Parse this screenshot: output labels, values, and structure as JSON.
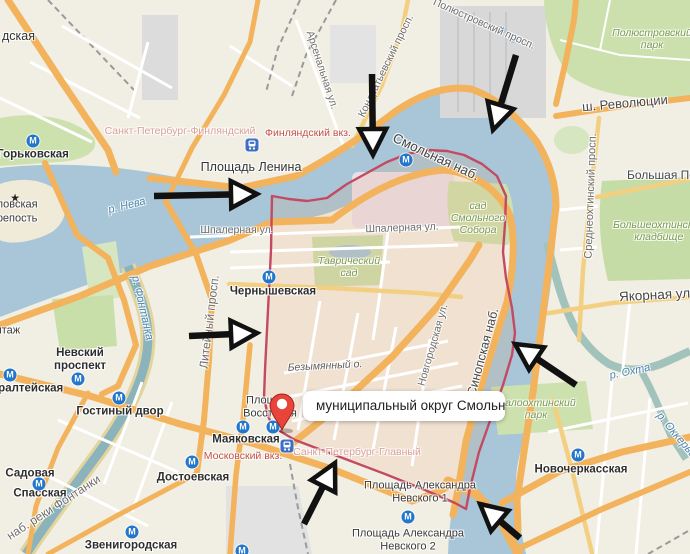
{
  "info_label": {
    "text": "муниципальный округ Смольн..."
  },
  "colors": {
    "water": "#a8c6d8",
    "land": "#f1eee3",
    "road_major": "#f2b35c",
    "road_secondary": "#f3cf82",
    "district_boundary": "#c24a62",
    "district_fill": "rgba(232,146,100,0.14)",
    "arrow": "#111111",
    "pin": "#e8443a",
    "metro_blue": "#2276cc",
    "rail_blue": "#3f6fc4",
    "park_green": "#cde1ae",
    "rail_text_red": "#c35049"
  },
  "icons": {
    "metro_letter": "М",
    "fortress_star": "★"
  },
  "star": {
    "x": 15,
    "y": 198
  },
  "labels": [
    {
      "text": "дская",
      "cls": "place-lg",
      "x": 2,
      "y": 36,
      "left": true
    },
    {
      "text": "Горьковская",
      "cls": "place-bold",
      "x": 33,
      "y": 155
    },
    {
      "text": "Санкт-Петербург-Финляндский",
      "cls": "rail-pale",
      "x": 180,
      "y": 131
    },
    {
      "text": "Финляндский вкз.",
      "cls": "rail-red",
      "x": 308,
      "y": 133
    },
    {
      "text": "Площадь Ленина",
      "cls": "place-lg",
      "x": 251,
      "y": 167
    },
    {
      "text": "Арсенальная ул.",
      "cls": "street",
      "x": 322,
      "y": 70,
      "rot": 72
    },
    {
      "text": "Кондратьевский просп.",
      "cls": "street",
      "x": 386,
      "y": 66,
      "rot": -64
    },
    {
      "text": "Полюстровский просп.",
      "cls": "street",
      "x": 484,
      "y": 24,
      "rot": 24
    },
    {
      "text": "Полюстровский\nпарк",
      "cls": "park-lbl",
      "x": 652,
      "y": 39
    },
    {
      "text": "ш. Революции",
      "cls": "street-dark",
      "x": 625,
      "y": 104,
      "rot": -5,
      "fs": 13
    },
    {
      "text": "Смольная наб.",
      "cls": "street-dark",
      "x": 436,
      "y": 157,
      "rot": 25,
      "fs": 13.5
    },
    {
      "text": "Среднеохтинский просп.",
      "cls": "street",
      "x": 591,
      "y": 196,
      "rot": -88,
      "fs": 11
    },
    {
      "text": "Большая Пороховская",
      "cls": "street-dark",
      "x": 627,
      "y": 176,
      "left": true
    },
    {
      "text": "Большеохтинское\nкладбище",
      "cls": "park-lbl",
      "x": 613,
      "y": 231,
      "left": true
    },
    {
      "text": "Якорная ул.",
      "cls": "street-dark",
      "x": 619,
      "y": 295,
      "left": true,
      "rot": -3,
      "fs": 13.5
    },
    {
      "text": "р. Нева",
      "cls": "water-lbl",
      "x": 127,
      "y": 206,
      "rot": -14
    },
    {
      "text": "Петропавловская",
      "cls": "place",
      "x": -52,
      "y": 205,
      "left": true
    },
    {
      "text": "крепость",
      "cls": "place",
      "x": -8,
      "y": 219,
      "left": true
    },
    {
      "text": "Эрмитаж",
      "cls": "place",
      "x": -26,
      "y": 331,
      "left": true
    },
    {
      "text": "Шпалерная ул.",
      "cls": "street",
      "x": 237,
      "y": 230
    },
    {
      "text": "Шпалерная ул.",
      "cls": "street",
      "x": 402,
      "y": 228,
      "rot": -2
    },
    {
      "text": "Таврический\nсад",
      "cls": "park-lbl",
      "x": 349,
      "y": 267
    },
    {
      "text": "Чернышевская",
      "cls": "place-bold",
      "x": 273,
      "y": 292
    },
    {
      "text": "Литейный просп.",
      "cls": "street",
      "x": 210,
      "y": 322,
      "rot": -83,
      "fs": 12
    },
    {
      "text": "р. Фонтанка",
      "cls": "water-lbl",
      "x": 142,
      "y": 308,
      "rot": 77
    },
    {
      "text": "наб. реки Фонтанки",
      "cls": "street",
      "x": 54,
      "y": 508,
      "rot": -33,
      "fs": 12
    },
    {
      "text": "Невский\nпроспект",
      "cls": "place-bold",
      "x": 80,
      "y": 360
    },
    {
      "text": "Адмиралтейская",
      "cls": "place-bold",
      "x": -33,
      "y": 389,
      "left": true
    },
    {
      "text": "Гостиный двор",
      "cls": "place-bold",
      "x": 120,
      "y": 412
    },
    {
      "text": "Садовая",
      "cls": "place-bold",
      "x": 30,
      "y": 474
    },
    {
      "text": "Спасская",
      "cls": "place-bold",
      "x": 40,
      "y": 494
    },
    {
      "text": "Достоевская",
      "cls": "place-bold",
      "x": 193,
      "y": 478
    },
    {
      "text": "Звенигородская",
      "cls": "place-bold",
      "x": 131,
      "y": 546
    },
    {
      "text": "Маяковская",
      "cls": "place-bold",
      "x": 246,
      "y": 440
    },
    {
      "text": "Московский вкз.",
      "cls": "rail-red",
      "x": 243,
      "y": 456
    },
    {
      "text": "Санкт-Петербург-Главный",
      "cls": "rail-pale",
      "x": 357,
      "y": 452
    },
    {
      "text": "Площадь\nВосстания",
      "cls": "place",
      "x": 270,
      "y": 407
    },
    {
      "text": "Безымянный о.",
      "cls": "island-lbl",
      "x": 325,
      "y": 366,
      "rot": -3
    },
    {
      "text": "Новгородская ул.",
      "cls": "street",
      "x": 433,
      "y": 345,
      "rot": -74
    },
    {
      "text": "Синопская наб.",
      "cls": "street-dark",
      "x": 483,
      "y": 352,
      "rot": -75,
      "fs": 12.5
    },
    {
      "text": "сад\nСмольного\nСобора",
      "cls": "park-lbl",
      "x": 478,
      "y": 218
    },
    {
      "text": "Малоохтинский\nпарк",
      "cls": "park-lbl",
      "x": 536,
      "y": 409
    },
    {
      "text": "р. Охта",
      "cls": "water-lbl",
      "x": 630,
      "y": 372,
      "rot": -12
    },
    {
      "text": "р. Оккервиль",
      "cls": "water-lbl",
      "x": 680,
      "y": 440,
      "rot": 50
    },
    {
      "text": "Новочеркасская",
      "cls": "place-bold",
      "x": 581,
      "y": 470
    },
    {
      "text": "Площадь Александра\nНевского 1",
      "cls": "place",
      "x": 420,
      "y": 492
    },
    {
      "text": "Площадь Александра\nНевского 2",
      "cls": "place",
      "x": 408,
      "y": 540
    }
  ],
  "metro_icons": [
    {
      "x": 33,
      "y": 141,
      "station": "Горьковская"
    },
    {
      "x": 406,
      "y": 160,
      "station": "Площадь Ленина"
    },
    {
      "x": 269,
      "y": 277,
      "station": "Чернышевская"
    },
    {
      "x": 78,
      "y": 379,
      "station": "Невский проспект"
    },
    {
      "x": 10,
      "y": 375,
      "station": "Адмиралтейская"
    },
    {
      "x": 119,
      "y": 398,
      "station": "Гостиный двор"
    },
    {
      "x": 39,
      "y": 484,
      "station": "Садовая"
    },
    {
      "x": 192,
      "y": 462,
      "station": "Достоевская"
    },
    {
      "x": 132,
      "y": 532,
      "station": "Звенигородская"
    },
    {
      "x": 243,
      "y": 427,
      "station": "Маяковская"
    },
    {
      "x": 273,
      "y": 427,
      "station": "Площадь Восстания"
    },
    {
      "x": 578,
      "y": 455,
      "station": "Новочеркасская"
    },
    {
      "x": 408,
      "y": 517,
      "station": "Площадь Александра Невского"
    },
    {
      "x": 242,
      "y": 551,
      "station": "Лиговский проспект"
    }
  ],
  "rail_icons": [
    {
      "x": 252,
      "y": 145,
      "station": "Финляндский вокзал"
    },
    {
      "x": 287,
      "y": 446,
      "station": "Московский вокзал"
    }
  ],
  "pin": {
    "x": 282,
    "y": 430
  },
  "arrows": [
    {
      "sx": 372,
      "sy": 74,
      "tx": 373,
      "ty": 155
    },
    {
      "sx": 516,
      "sy": 55,
      "tx": 493,
      "ty": 130
    },
    {
      "sx": 154,
      "sy": 196,
      "tx": 257,
      "ty": 194
    },
    {
      "sx": 189,
      "sy": 336,
      "tx": 257,
      "ty": 333
    },
    {
      "sx": 576,
      "sy": 385,
      "tx": 515,
      "ty": 344
    },
    {
      "sx": 304,
      "sy": 524,
      "tx": 335,
      "ty": 463
    },
    {
      "sx": 520,
      "sy": 538,
      "tx": 480,
      "ty": 504
    }
  ]
}
